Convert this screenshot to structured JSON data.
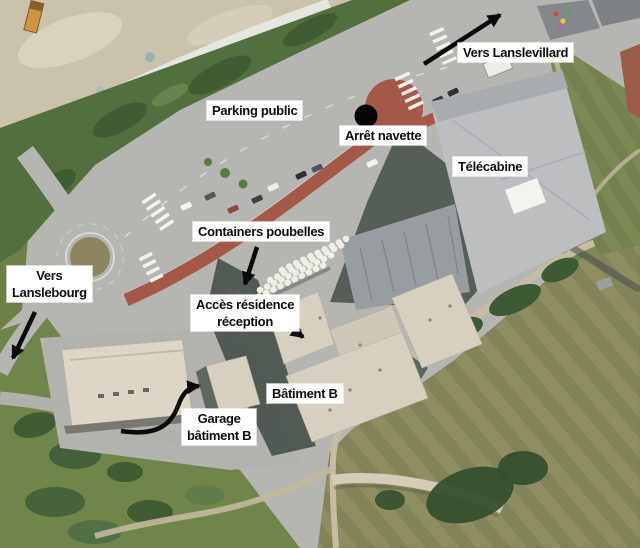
{
  "map": {
    "kind": "aerial-access-plan",
    "annotations": {
      "vers_lanslevillard": "Vers Lanslevillard",
      "parking_public": "Parking public",
      "arret_navette": "Arrêt navette",
      "telecabine": "Télécabine",
      "containers_poubelles": "Containers poubelles",
      "vers_lanslebourg": "Vers\nLanslebourg",
      "acces_residence": "Accès résidence\nréception",
      "batiment_b": "Bâtiment B",
      "garage_batiment_b": "Garage\nbâtiment B"
    },
    "markers": {
      "shuttle_stop_dot": "black-dot"
    },
    "colors": {
      "annotation_bg": "#ffffff",
      "annotation_text": "#0d0d0d",
      "arrow": "#0a0a0a",
      "shuttle_stop_dot": "#050505",
      "road_gray": "#b5b5b1",
      "red_pavement": "#a65848",
      "riverbed": "#cbc2ac",
      "vegetation": "#52703e",
      "field_green": "#8e8e60",
      "building_beige": "#d7d0c0",
      "building_roof_gray": "#bcbec0",
      "shadow": "#49524b"
    }
  }
}
